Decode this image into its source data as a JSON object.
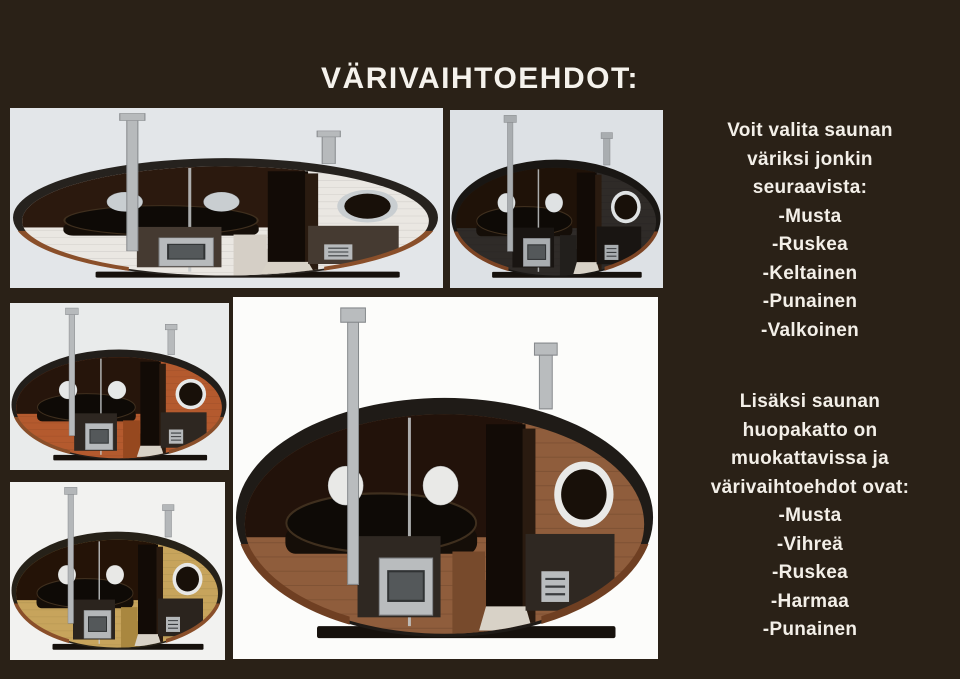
{
  "page": {
    "title": "VÄRIVAIHTOEHDOT:",
    "colors": {
      "background": "#2a2117",
      "text": "#f3efe8",
      "title_text": "#f5f2ec"
    }
  },
  "text_blocks": {
    "body_colors": {
      "lines": [
        "Voit valita saunan",
        "väriksi jonkin",
        "seuraavista:",
        "-Musta",
        "-Ruskea",
        "-Keltainen",
        "-Punainen",
        "-Valkoinen"
      ]
    },
    "roof_colors": {
      "lines": [
        "Lisäksi saunan",
        "huopakatto on",
        "muokattavissa ja",
        "värivaihtoehdot ovat:",
        "-Musta",
        "-Vihreä",
        "-Ruskea",
        "-Harmaa",
        "-Punainen"
      ]
    }
  },
  "saunas": [
    {
      "id": "white",
      "variant": "valkoinen",
      "panel_bg": "#e3e6e9",
      "body": "#eae7e2",
      "body_dark": "#d5cfc6",
      "roof": "#26221e",
      "interior": "#2b190e",
      "window": "#c9ced1",
      "metal": "#b7babc",
      "panel_dark": "#453a31",
      "trim": "#8a4f2a"
    },
    {
      "id": "black",
      "variant": "musta",
      "panel_bg": "#dde1e5",
      "body": "#2f2b28",
      "body_dark": "#221f1c",
      "roof": "#191613",
      "interior": "#1f1208",
      "window": "#dfe2e3",
      "metal": "#a9adb0",
      "panel_dark": "#191512",
      "trim": "#7c4424"
    },
    {
      "id": "orange",
      "variant": "punainen",
      "panel_bg": "#e9ebeb",
      "body": "#b45a2e",
      "body_dark": "#96481f",
      "roof": "#221e1a",
      "interior": "#26150b",
      "window": "#e6e8e8",
      "metal": "#b7babc",
      "panel_dark": "#2e2721",
      "trim": "#8a4f2a"
    },
    {
      "id": "yellow",
      "variant": "keltainen",
      "panel_bg": "#f2f2f0",
      "body": "#c7a45c",
      "body_dark": "#a9873f",
      "roof": "#262118",
      "interior": "#241307",
      "window": "#e8e8e6",
      "metal": "#b4b7b9",
      "panel_dark": "#2b241e",
      "trim": "#8a4f2a"
    },
    {
      "id": "brown",
      "variant": "ruskea",
      "panel_bg": "#fcfcfa",
      "body": "#8f5d3c",
      "body_dark": "#774a2c",
      "roof": "#1f1b17",
      "interior": "#22120a",
      "window": "#e9e9e7",
      "metal": "#b9bcbe",
      "panel_dark": "#2f2822",
      "trim": "#6f3f22"
    }
  ]
}
